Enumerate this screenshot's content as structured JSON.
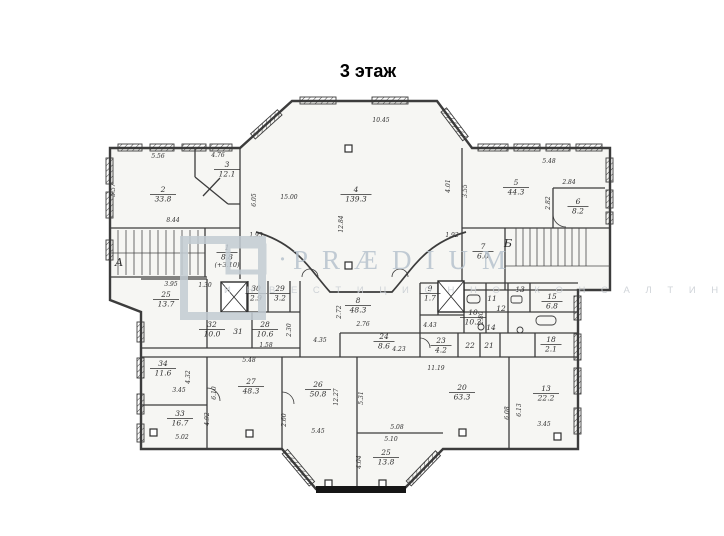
{
  "title": "3 этаж",
  "watermark": {
    "brand": "PRÆDIUM",
    "separator": "·",
    "subtitle": "И Н В Е С Т И Ц И О Н Н О - К О Н С А Л Т И Н Г О В А Я   К О М П А Н И Я"
  },
  "plan": {
    "stair_letters": [
      {
        "t": "А",
        "x": 119,
        "y": 266
      },
      {
        "t": "Б",
        "x": 508,
        "y": 247
      }
    ],
    "notes": [
      {
        "t": "(+3.10)",
        "x": 227,
        "y": 267
      }
    ],
    "rooms": [
      {
        "n": "1",
        "a": "8.8",
        "x": 227,
        "y": 250
      },
      {
        "n": "2",
        "a": "33.8",
        "x": 163,
        "y": 192
      },
      {
        "n": "3",
        "a": "12.1",
        "x": 227,
        "y": 167
      },
      {
        "n": "4",
        "a": "139.3",
        "x": 356,
        "y": 192
      },
      {
        "n": "5",
        "a": "44.3",
        "x": 516,
        "y": 185
      },
      {
        "n": "6",
        "a": "8.2",
        "x": 578,
        "y": 204
      },
      {
        "n": "7",
        "a": "6.0",
        "x": 483,
        "y": 249
      },
      {
        "n": "8",
        "a": "48.3",
        "x": 358,
        "y": 303
      },
      {
        "n": "9",
        "a": "1.7",
        "x": 430,
        "y": 291
      },
      {
        "n": "10",
        "a": "10.2",
        "x": 473,
        "y": 315
      },
      {
        "n": "11",
        "a": null,
        "x": 492,
        "y": 301
      },
      {
        "n": "12",
        "a": null,
        "x": 501,
        "y": 311
      },
      {
        "n": "13",
        "a": null,
        "x": 520,
        "y": 292
      },
      {
        "n": "14",
        "a": null,
        "x": 491,
        "y": 330
      },
      {
        "n": "15",
        "a": "6.8",
        "x": 552,
        "y": 299
      },
      {
        "n": "18",
        "a": "2.1",
        "x": 551,
        "y": 342
      },
      {
        "n": "13",
        "a": "22.2",
        "x": 546,
        "y": 391
      },
      {
        "n": "20",
        "a": "63.3",
        "x": 462,
        "y": 390
      },
      {
        "n": "21",
        "a": null,
        "x": 489,
        "y": 348
      },
      {
        "n": "22",
        "a": null,
        "x": 470,
        "y": 348
      },
      {
        "n": "23",
        "a": "4.2",
        "x": 441,
        "y": 343
      },
      {
        "n": "24",
        "a": "8.6",
        "x": 384,
        "y": 339
      },
      {
        "n": "25",
        "a": "13.7",
        "x": 166,
        "y": 297
      },
      {
        "n": "25",
        "a": "13.8",
        "x": 386,
        "y": 455
      },
      {
        "n": "26",
        "a": "50.8",
        "x": 318,
        "y": 387
      },
      {
        "n": "27",
        "a": "48.3",
        "x": 251,
        "y": 384
      },
      {
        "n": "28",
        "a": "10.6",
        "x": 265,
        "y": 327
      },
      {
        "n": "29",
        "a": "3.2",
        "x": 280,
        "y": 291
      },
      {
        "n": "30",
        "a": "2.9",
        "x": 256,
        "y": 291
      },
      {
        "n": "31",
        "a": null,
        "x": 238,
        "y": 334
      },
      {
        "n": "32",
        "a": "10.0",
        "x": 212,
        "y": 327
      },
      {
        "n": "33",
        "a": "16.7",
        "x": 180,
        "y": 416
      },
      {
        "n": "34",
        "a": "11.6",
        "x": 163,
        "y": 366
      }
    ],
    "dims": [
      {
        "t": "5.56",
        "x": 158,
        "y": 158,
        "r": 0
      },
      {
        "t": "4.76",
        "x": 218,
        "y": 157,
        "r": 0
      },
      {
        "t": "5.57",
        "x": 115,
        "y": 190,
        "r": 90
      },
      {
        "t": "8.44",
        "x": 173,
        "y": 222,
        "r": 0
      },
      {
        "t": "6.05",
        "x": 256,
        "y": 200,
        "r": 90
      },
      {
        "t": "15.00",
        "x": 289,
        "y": 199,
        "r": 0
      },
      {
        "t": "10.45",
        "x": 381,
        "y": 122,
        "r": 0
      },
      {
        "t": "12.84",
        "x": 343,
        "y": 224,
        "r": 90
      },
      {
        "t": "4.01",
        "x": 450,
        "y": 186,
        "r": 90
      },
      {
        "t": "3.55",
        "x": 467,
        "y": 191,
        "r": 90
      },
      {
        "t": "5.48",
        "x": 549,
        "y": 163,
        "r": 0
      },
      {
        "t": "2.84",
        "x": 569,
        "y": 184,
        "r": 0
      },
      {
        "t": "2.82",
        "x": 550,
        "y": 203,
        "r": 90
      },
      {
        "t": "1.93",
        "x": 256,
        "y": 237,
        "r": 0
      },
      {
        "t": "1.92",
        "x": 452,
        "y": 237,
        "r": 0
      },
      {
        "t": "1.30",
        "x": 205,
        "y": 287,
        "r": 0
      },
      {
        "t": "3.95",
        "x": 171,
        "y": 286,
        "r": 0
      },
      {
        "t": "1.58",
        "x": 266,
        "y": 347,
        "r": 0
      },
      {
        "t": "2.30",
        "x": 291,
        "y": 330,
        "r": 90
      },
      {
        "t": "2.76",
        "x": 363,
        "y": 326,
        "r": 0
      },
      {
        "t": "4.35",
        "x": 320,
        "y": 342,
        "r": 0
      },
      {
        "t": "4.43",
        "x": 430,
        "y": 327,
        "r": 0
      },
      {
        "t": "2.80",
        "x": 483,
        "y": 318,
        "r": 90
      },
      {
        "t": "4.23",
        "x": 399,
        "y": 351,
        "r": 0
      },
      {
        "t": "11.19",
        "x": 436,
        "y": 370,
        "r": 0
      },
      {
        "t": "2.72",
        "x": 341,
        "y": 312,
        "r": 90
      },
      {
        "t": "5.48",
        "x": 249,
        "y": 362,
        "r": 0
      },
      {
        "t": "6.10",
        "x": 216,
        "y": 393,
        "r": 90
      },
      {
        "t": "4.92",
        "x": 209,
        "y": 419,
        "r": 90
      },
      {
        "t": "3.45",
        "x": 179,
        "y": 392,
        "r": 0
      },
      {
        "t": "4.32",
        "x": 190,
        "y": 377,
        "r": 90
      },
      {
        "t": "5.02",
        "x": 182,
        "y": 439,
        "r": 0
      },
      {
        "t": "12.27",
        "x": 338,
        "y": 397,
        "r": 90
      },
      {
        "t": "5.31",
        "x": 363,
        "y": 398,
        "r": 90
      },
      {
        "t": "2.60",
        "x": 286,
        "y": 420,
        "r": 90
      },
      {
        "t": "5.45",
        "x": 318,
        "y": 433,
        "r": 0
      },
      {
        "t": "5.08",
        "x": 397,
        "y": 429,
        "r": 0
      },
      {
        "t": "5.10",
        "x": 391,
        "y": 441,
        "r": 0
      },
      {
        "t": "4.04",
        "x": 361,
        "y": 462,
        "r": 90
      },
      {
        "t": "6.08",
        "x": 509,
        "y": 413,
        "r": 90
      },
      {
        "t": "6.13",
        "x": 521,
        "y": 410,
        "r": 90
      },
      {
        "t": "3.45",
        "x": 544,
        "y": 426,
        "r": 0
      }
    ]
  }
}
